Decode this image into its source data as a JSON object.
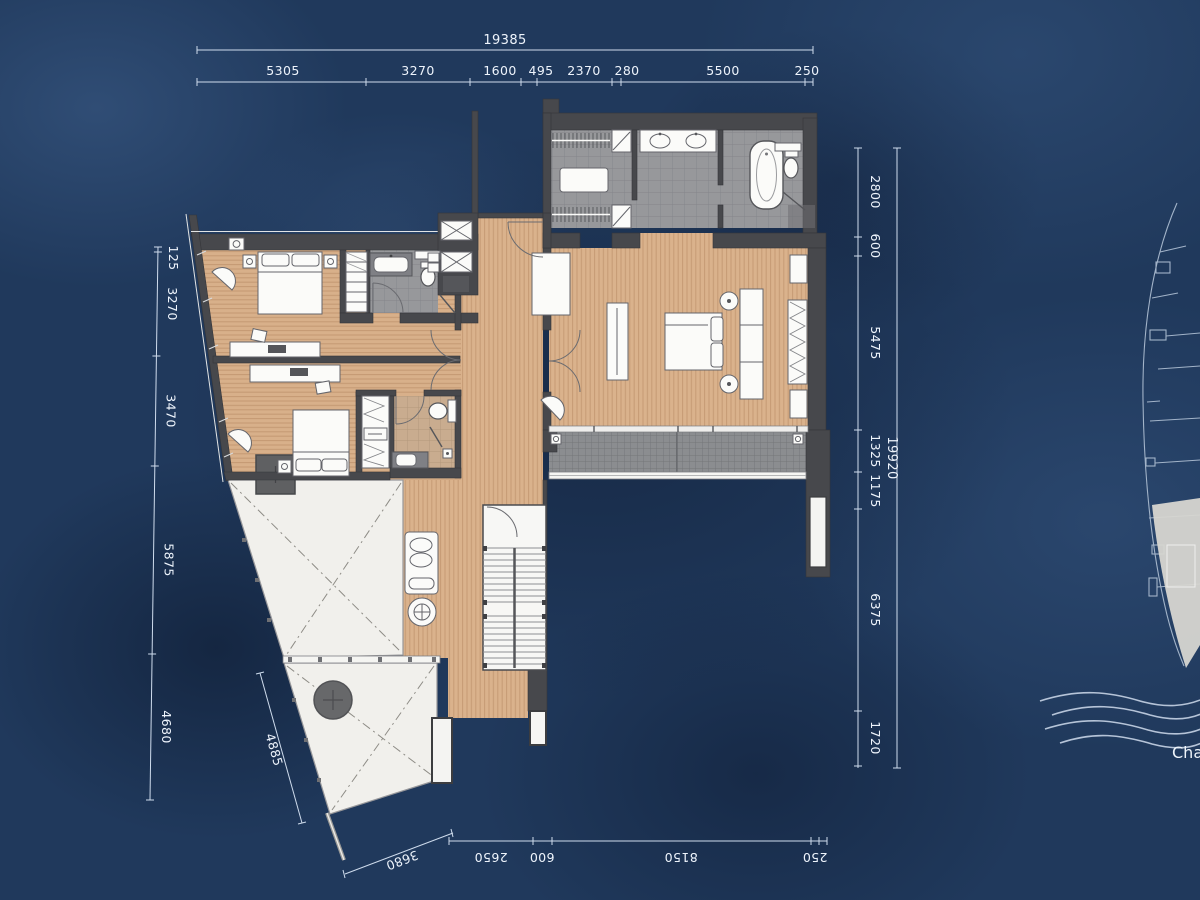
{
  "meta": {
    "drawing_type": "architectural floor plan on water-texture background",
    "colors": {
      "background_navy": "#20395c",
      "wall_gray": "#47484c",
      "wood_floor": "#dab28c",
      "tile_gray": "#97989b",
      "balcony_tile": "#8b8d90",
      "terrace_white": "#f1f0ec",
      "dimension_text": "#eef4fc"
    }
  },
  "dimensions": {
    "top": {
      "overall": "19385",
      "segments": [
        "5305",
        "3270",
        "1600",
        "495",
        "2370",
        "280",
        "5500",
        "250"
      ]
    },
    "right": {
      "overall": "19920",
      "segments": [
        "2800",
        "600",
        "5475",
        "1325",
        "1175",
        "6375",
        "1720"
      ]
    },
    "left": {
      "segments": [
        "125",
        "3270",
        "3470",
        "5875",
        "4680"
      ]
    },
    "bottom": {
      "segments": [
        "2650",
        "600",
        "8150",
        "250"
      ],
      "diagonal_lower": "3680",
      "diagonal_side": "4885"
    }
  },
  "annotations": {
    "river_label": "Cha"
  }
}
